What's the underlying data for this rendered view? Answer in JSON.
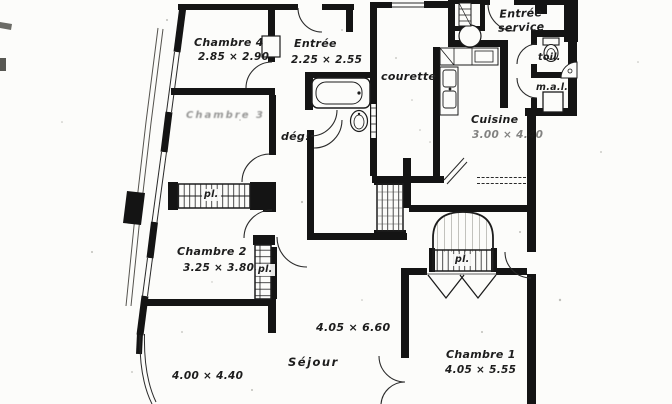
{
  "rooms": {
    "chambre4": {
      "name": "Chambre 4",
      "dims": "2.85 × 2.90"
    },
    "entree": {
      "name": "Entrée",
      "dims": "2.25 × 2.55"
    },
    "courette": {
      "name": "courette"
    },
    "entree_service": {
      "line1": "Entrée",
      "line2": "service"
    },
    "toilettes": {
      "name": "toil."
    },
    "machine_a_laver": {
      "name": "m.a.l."
    },
    "cuisine": {
      "name": "Cuisine",
      "dims": "3.00 × 4.40"
    },
    "chambre3": {
      "name": "Chambre 3"
    },
    "degagement": {
      "name": "dég!"
    },
    "chambre2": {
      "name": "Chambre 2",
      "dims": "3.25 × 3.80"
    },
    "sejour": {
      "name": "Séjour",
      "dims_main": "4.05 × 6.60",
      "dims_left": "4.00 × 4.40"
    },
    "chambre1": {
      "name": "Chambre 1",
      "dims": "4.05 × 5.55"
    }
  },
  "closets": {
    "placard_label": "pl."
  },
  "colors": {
    "ink": "#161616",
    "paper": "#fcfcfa",
    "hatch": "#3a3a3a"
  }
}
